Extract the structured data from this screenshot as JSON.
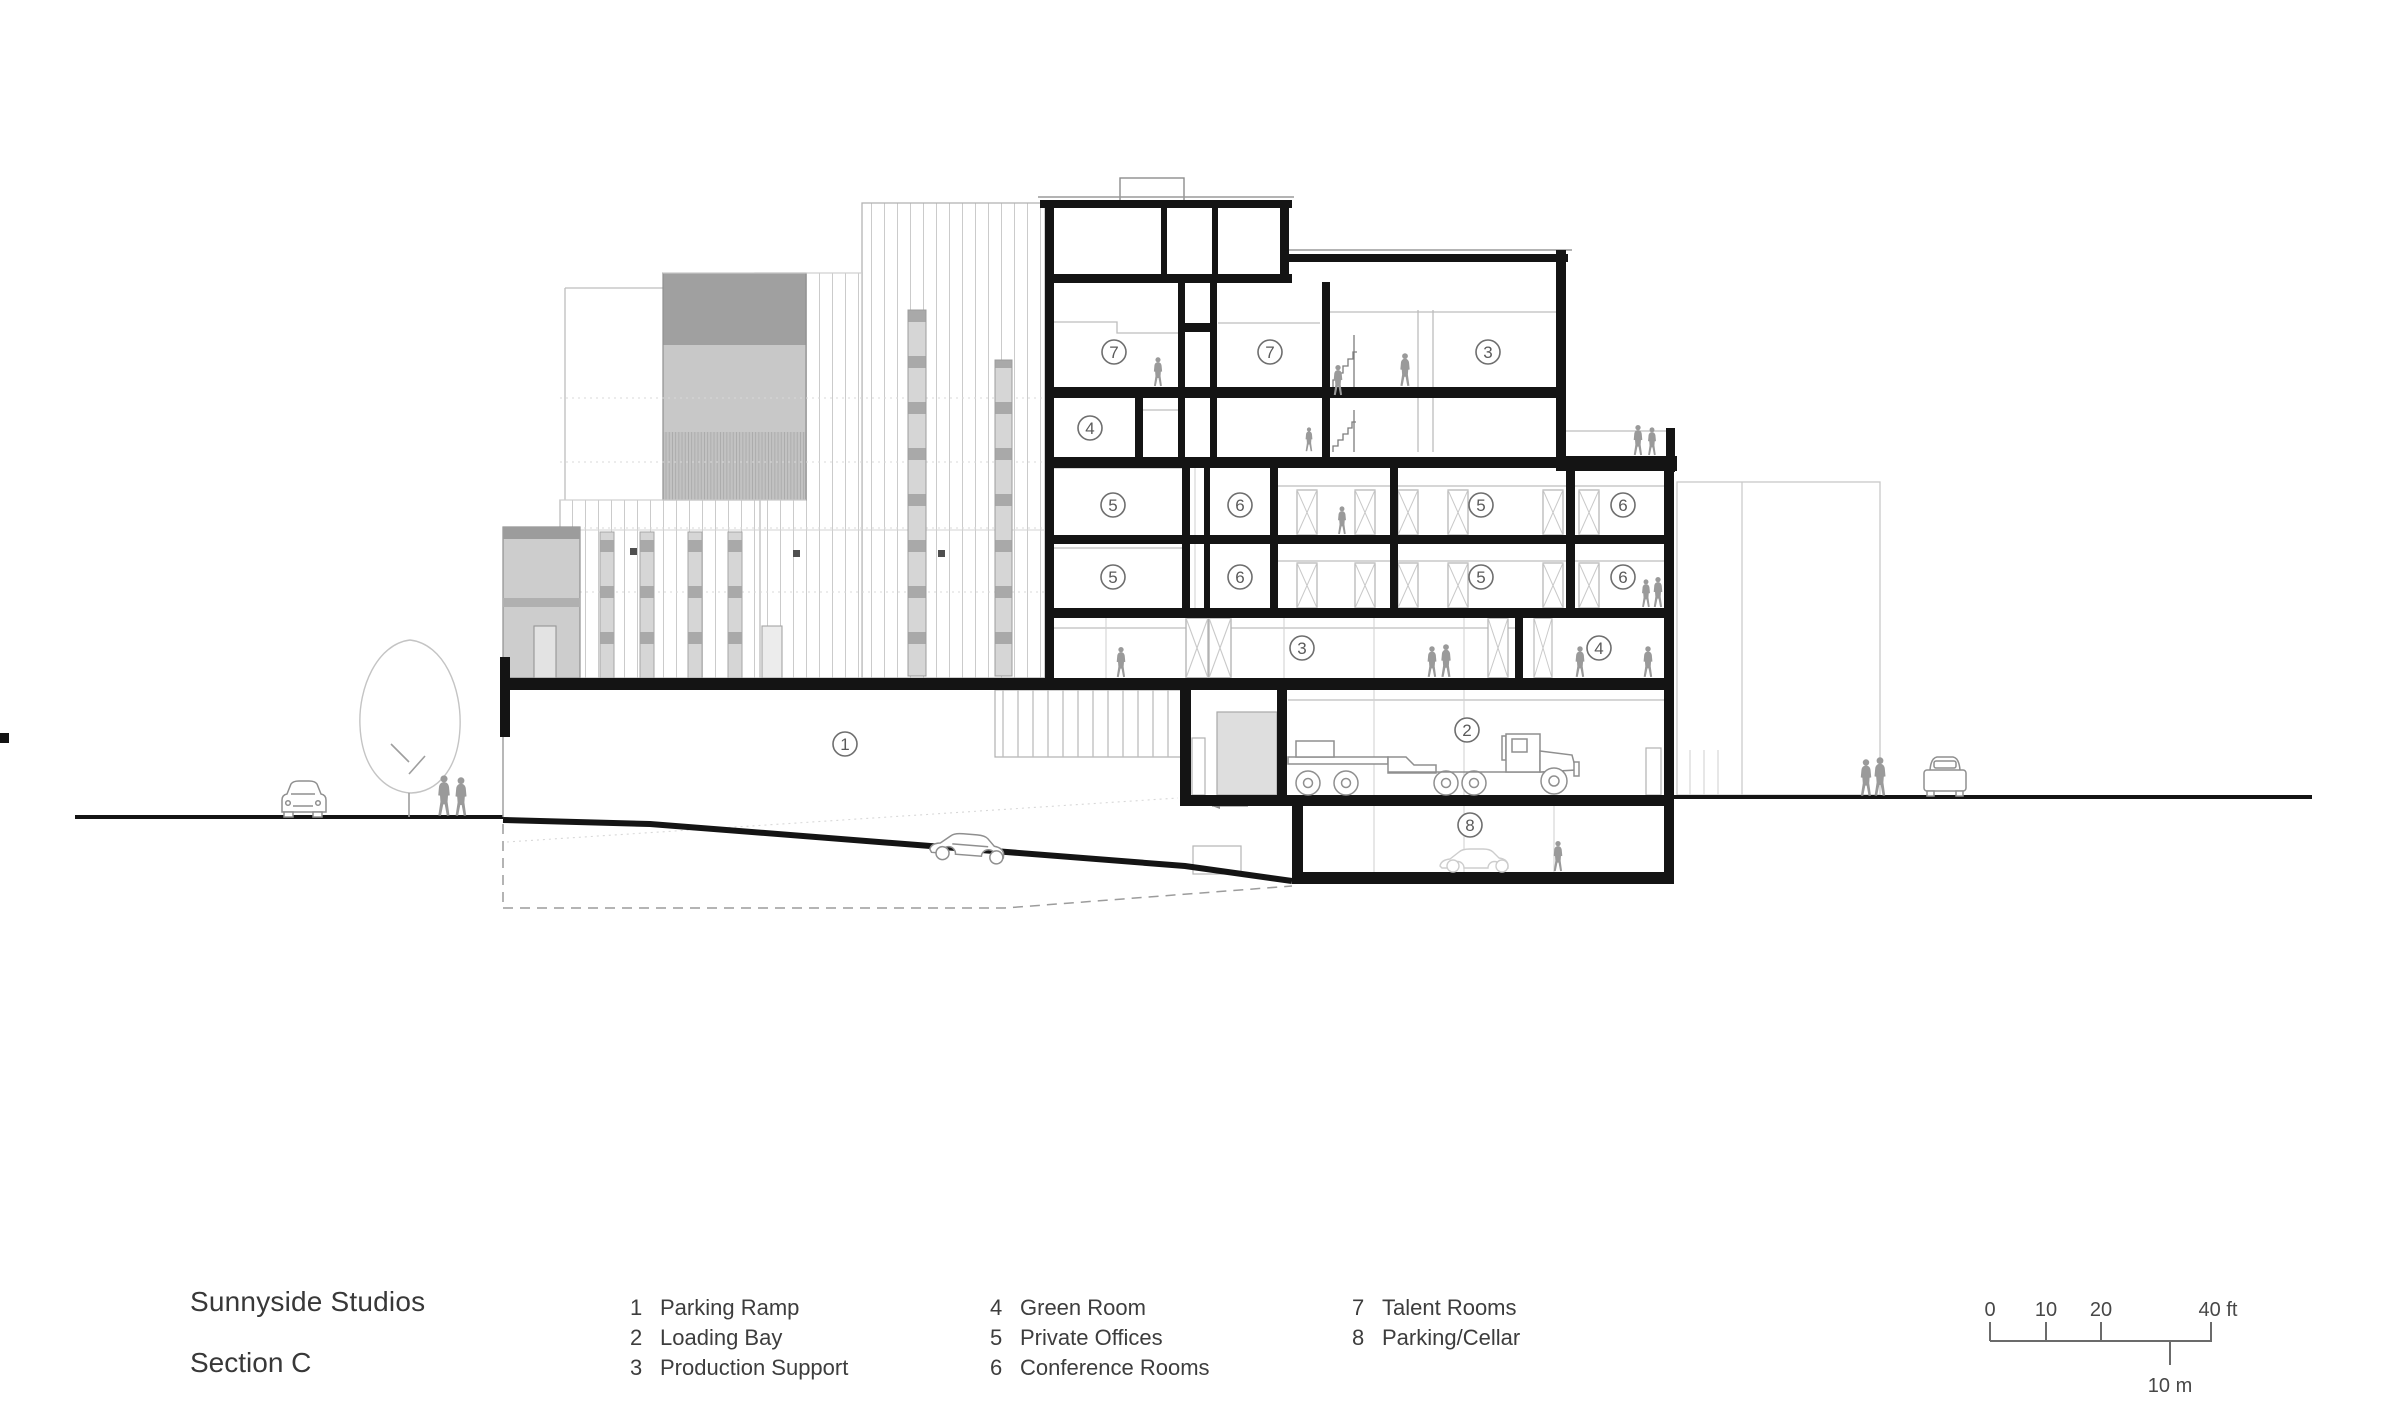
{
  "title_block": {
    "project": "Sunnyside Studios",
    "sheet": "Section C"
  },
  "legend": {
    "columns": [
      [
        {
          "num": "1",
          "label": "Parking Ramp"
        },
        {
          "num": "2",
          "label": "Loading Bay"
        },
        {
          "num": "3",
          "label": "Production Support"
        }
      ],
      [
        {
          "num": "4",
          "label": "Green Room"
        },
        {
          "num": "5",
          "label": "Private Offices"
        },
        {
          "num": "6",
          "label": "Conference Rooms"
        }
      ],
      [
        {
          "num": "7",
          "label": "Talent Rooms"
        },
        {
          "num": "8",
          "label": "Parking/Cellar"
        }
      ]
    ]
  },
  "scale_bar": {
    "ft_ticks": [
      "0",
      "10",
      "20",
      "40 ft"
    ],
    "m_label": "10 m"
  },
  "room_markers": [
    {
      "num": "7",
      "x": 1114,
      "y": 352
    },
    {
      "num": "7",
      "x": 1270,
      "y": 352
    },
    {
      "num": "3",
      "x": 1488,
      "y": 352
    },
    {
      "num": "4",
      "x": 1090,
      "y": 428
    },
    {
      "num": "5",
      "x": 1113,
      "y": 505
    },
    {
      "num": "6",
      "x": 1240,
      "y": 505
    },
    {
      "num": "5",
      "x": 1481,
      "y": 505
    },
    {
      "num": "6",
      "x": 1623,
      "y": 505
    },
    {
      "num": "5",
      "x": 1113,
      "y": 577
    },
    {
      "num": "6",
      "x": 1240,
      "y": 577
    },
    {
      "num": "5",
      "x": 1481,
      "y": 577
    },
    {
      "num": "6",
      "x": 1623,
      "y": 577
    },
    {
      "num": "3",
      "x": 1302,
      "y": 648
    },
    {
      "num": "4",
      "x": 1599,
      "y": 648
    },
    {
      "num": "1",
      "x": 845,
      "y": 744
    },
    {
      "num": "2",
      "x": 1467,
      "y": 730
    },
    {
      "num": "8",
      "x": 1470,
      "y": 825
    }
  ],
  "colors": {
    "cut_line": "#141414",
    "elevation_line": "#bdbdbd",
    "figure_gray": "#9a9a9a",
    "panel_gray": "#c6c6c6",
    "text": "#3a3a3a"
  }
}
